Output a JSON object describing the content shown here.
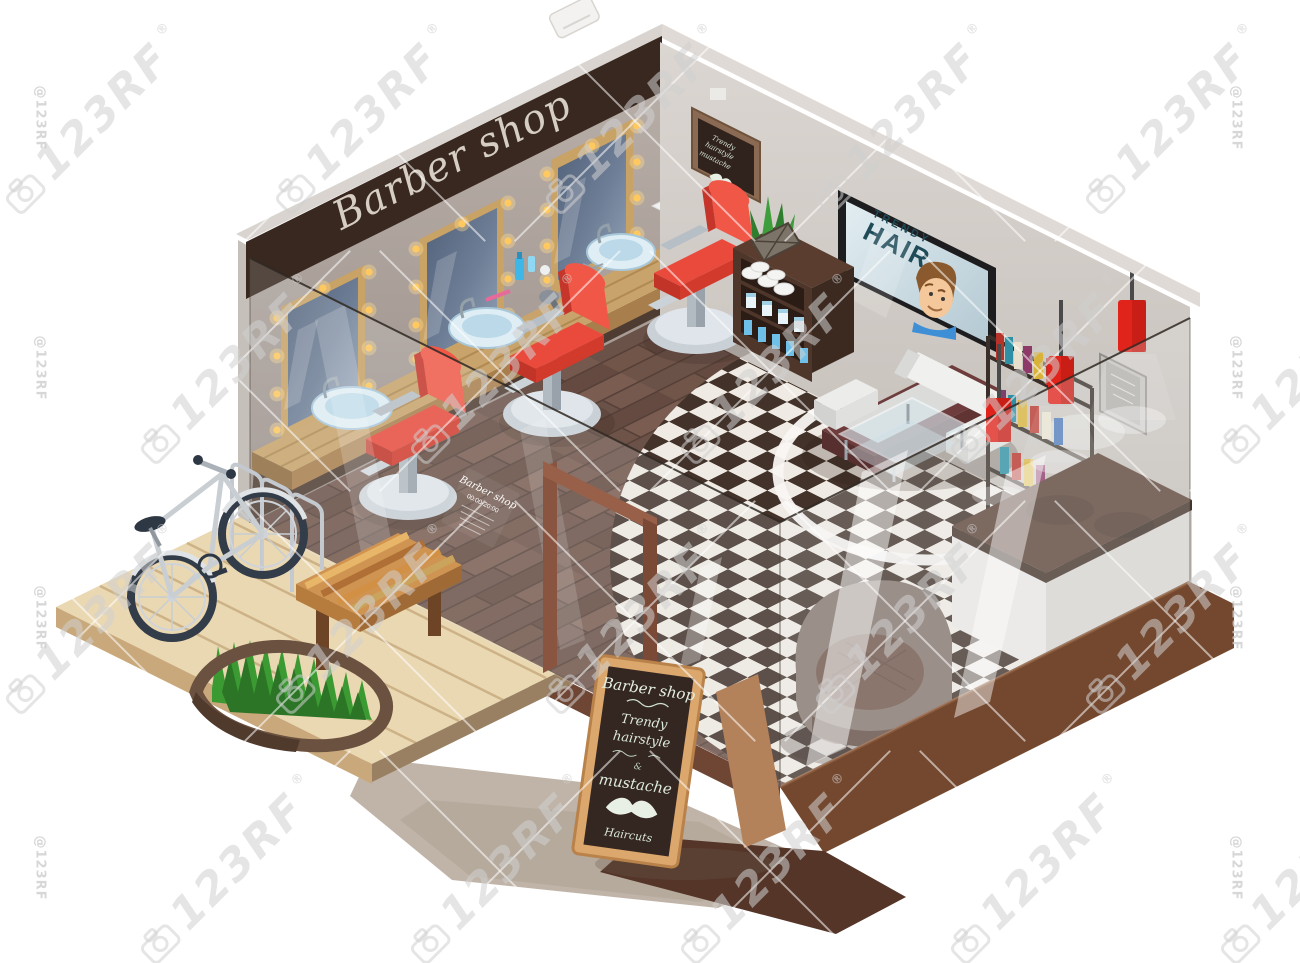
{
  "watermark": {
    "brand": "123RF",
    "reg": "®",
    "handle": "@123RF"
  },
  "storefront": {
    "sign": "Barber shop"
  },
  "tv": {
    "line1": "TRENDY",
    "line2": "HAIR"
  },
  "wall_chalkboard": {
    "line1": "Trendy",
    "line2": "hairstyle",
    "line3": "mustache"
  },
  "glass_sign": {
    "title": "Barber shop",
    "hours": "00:00-20:00"
  },
  "aframe_sign": {
    "title": "Barber shop",
    "line1": "Trendy",
    "line2": "hairstyle",
    "amp": "&",
    "line3": "mustache",
    "line4": "Haircuts"
  },
  "palette": {
    "accent_red": "#ea4a3c",
    "lamp_red": "#e0241b",
    "sign_brown": "#38281f",
    "wall_grey": "#cfc9c4",
    "floor_wood": "#5d453c",
    "deck_wood": "#ead8b2",
    "grass_green": "#3c9a33",
    "tv_text": "#1f4b58"
  }
}
